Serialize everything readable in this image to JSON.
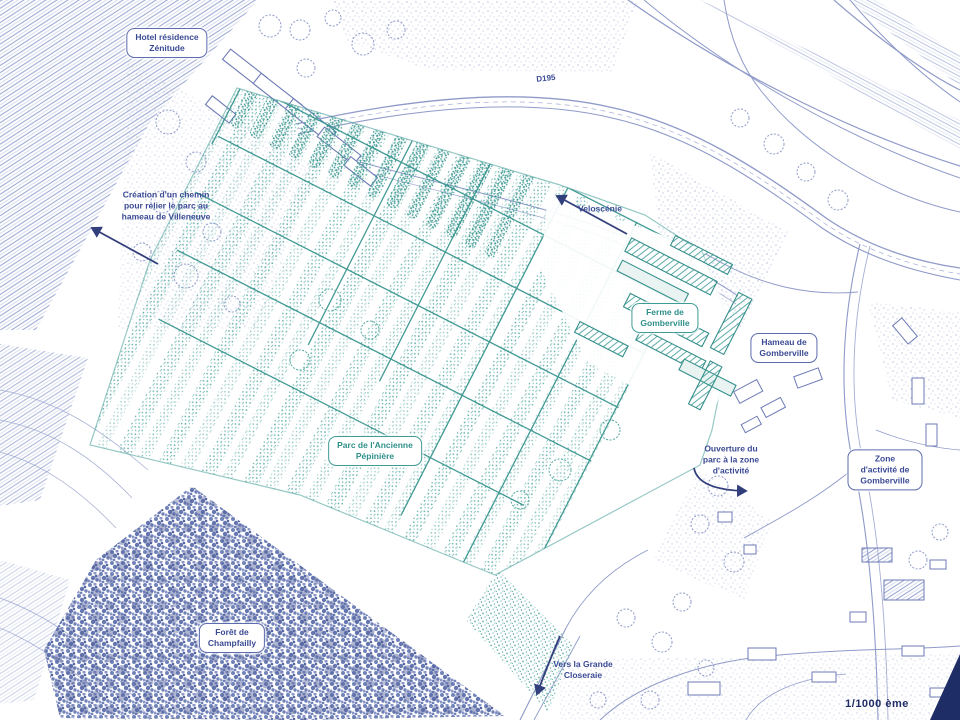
{
  "labels": {
    "hotel_zenitude": "Hotel résidence\nZénitude",
    "creation_chemin": "Création d'un chemin\npour relier le parc au\nhameau de Villeneuve",
    "d195": "D195",
    "veloscenie": "Veloscénie",
    "ferme_gomberville": "Ferme de\nGomberville",
    "hameau_gomberville": "Hameau de\nGomberville",
    "parc_ancienne_pepiniere": "Parc de l'Ancienne\nPépinière",
    "ouverture_parc": "Ouverture du\nparc à la zone\nd'activité",
    "zone_activite": "Zone d'activité de\nGomberville",
    "foret_champfailly": "Forêt de\nChampfailly",
    "vers_grande_closeraie": "Vers la Grande\nCloseraie",
    "scale": "1/1000 ème"
  },
  "colors": {
    "line_blue": "#8f9ac9",
    "text_blue": "#3a4a94",
    "arrow_navy": "#333f7d",
    "teal": "#3f9b95",
    "teal_dark": "#2f8f89",
    "forest_blue": "#7082b8",
    "corner_navy": "#1f2d66",
    "background": "#ffffff"
  }
}
